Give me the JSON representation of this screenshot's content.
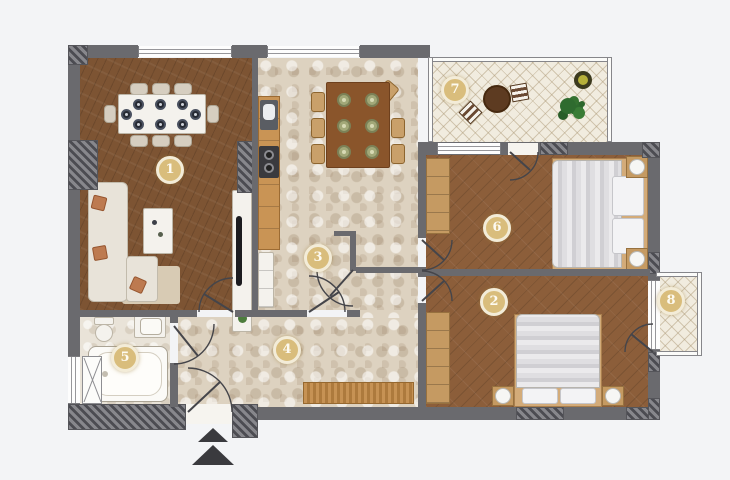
{
  "title": "apartment-floor-plan",
  "rooms": [
    {
      "number": "1",
      "name": "living-dining-room"
    },
    {
      "number": "2",
      "name": "bedroom"
    },
    {
      "number": "3",
      "name": "kitchen"
    },
    {
      "number": "4",
      "name": "hallway"
    },
    {
      "number": "5",
      "name": "bathroom"
    },
    {
      "number": "6",
      "name": "bedroom"
    },
    {
      "number": "7",
      "name": "terrace"
    },
    {
      "number": "8",
      "name": "balcony"
    }
  ],
  "entrance": {
    "arrow_icon": "up-triangle"
  },
  "colors": {
    "wall": "#6a6a6e",
    "wood_dark": "#7d5433",
    "wood_mid": "#8c5e3a",
    "tile": "#ddd2c0",
    "tile_light": "#e9e3d8",
    "balcony_tile": "#f1ecdf",
    "counter_wood": "#c99455",
    "badge_fill": "#d9bd7c",
    "badge_border": "#f3ecd8",
    "badge_text": "#fdfaf0",
    "arrow": "#3a3a3e",
    "plant_green": "#2f6b2f"
  }
}
